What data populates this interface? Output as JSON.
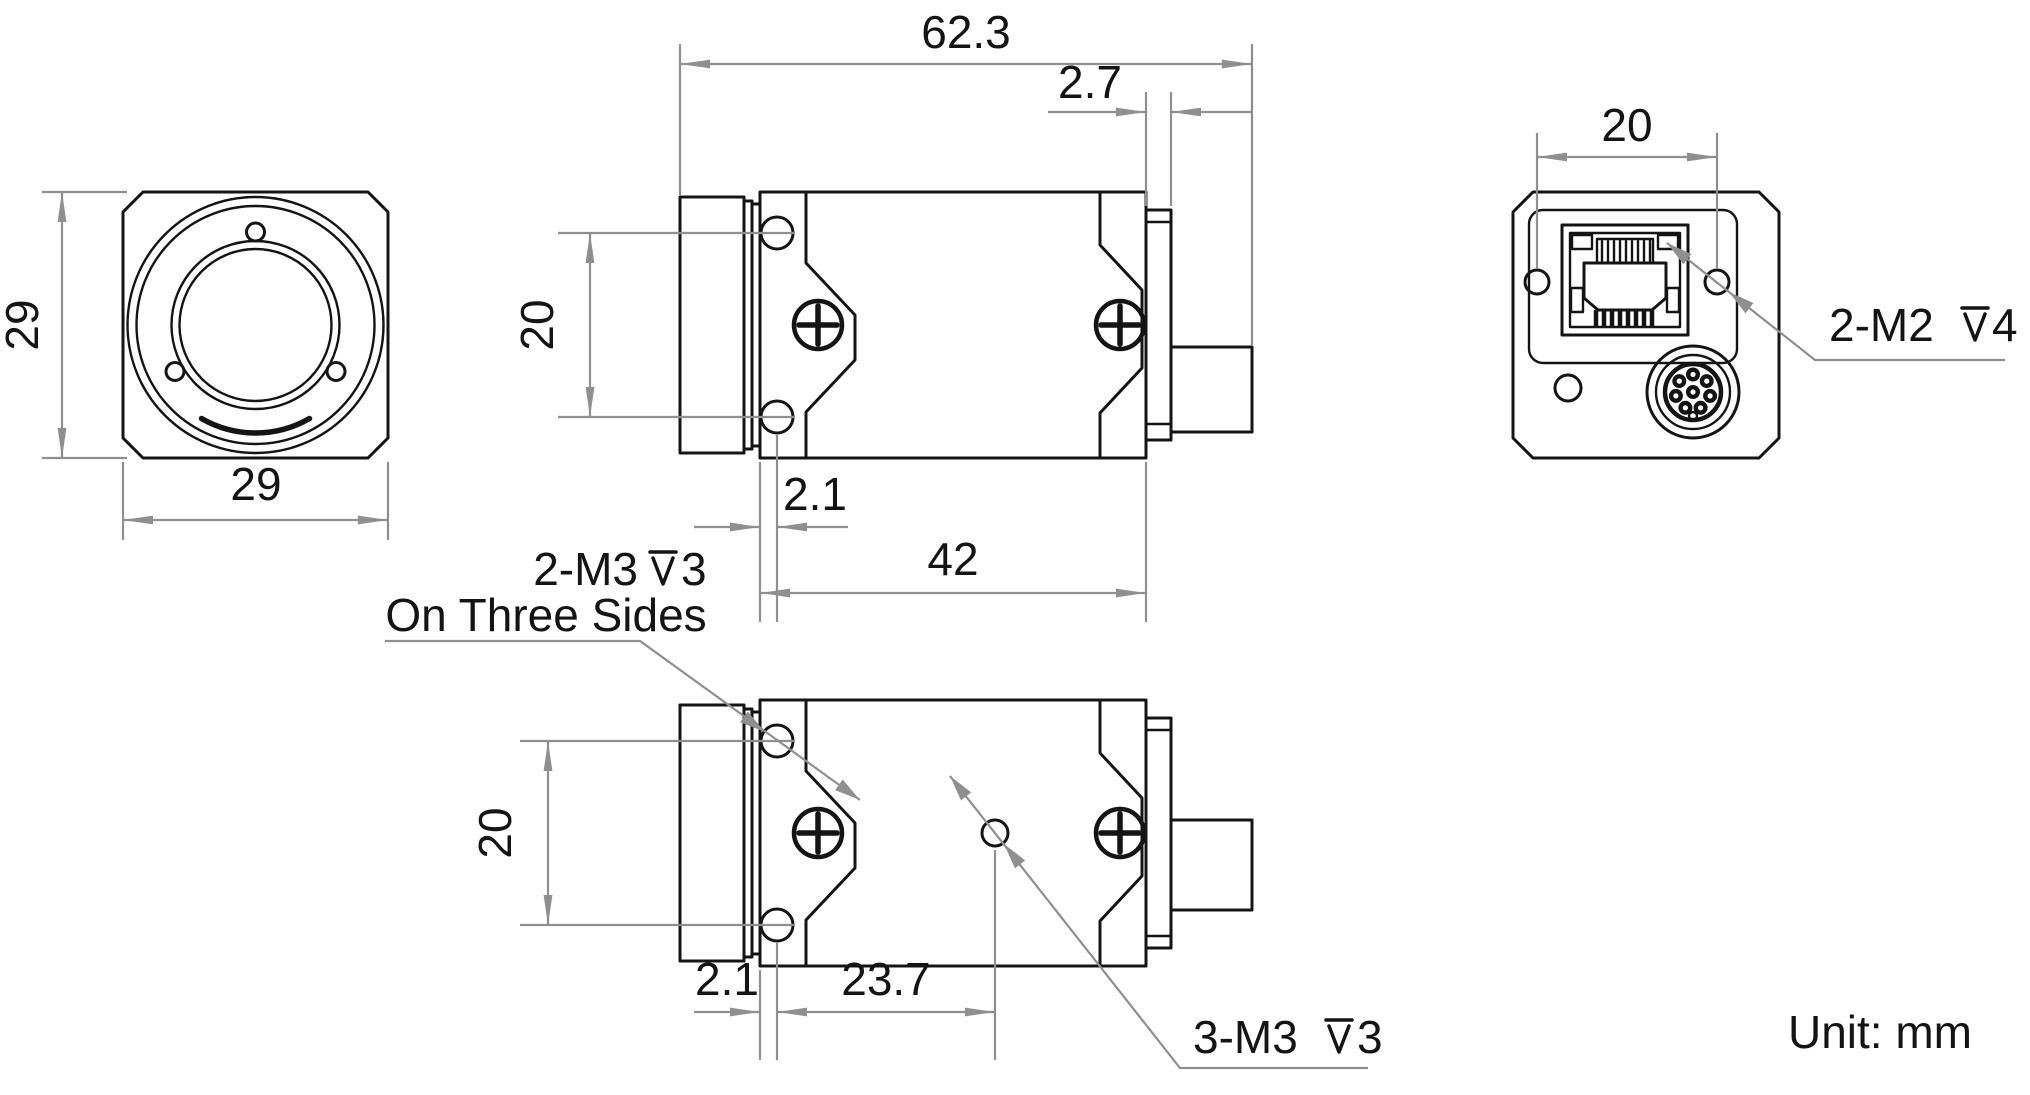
{
  "drawing": {
    "unit_note": "Unit: mm",
    "colors": {
      "geometry_line": "#141414",
      "dimension_line": "#8f8f8f"
    },
    "front_view": {
      "width_mm": "29",
      "height_mm": "29"
    },
    "side_view": {
      "total_length_mm": "62.3",
      "rear_cap_mm": "2.7",
      "mount_hole_spacing_mm": "20",
      "mount_hole_offset_mm": "2.1",
      "body_length_mm": "42"
    },
    "bottom_view": {
      "mount_hole_spacing_mm": "20",
      "mount_hole_offset_mm": "2.1",
      "tripod_hole_offset_mm": "23.7",
      "side_holes_label": {
        "prefix": "2-M3",
        "depth_mm": "3",
        "note": "On Three Sides"
      },
      "bottom_holes_label": {
        "prefix": "3-M3",
        "depth_mm": "3"
      }
    },
    "rear_view": {
      "screw_spacing_mm": "20",
      "rear_holes_label": {
        "prefix": "2-M2",
        "depth_mm": "4"
      }
    }
  }
}
